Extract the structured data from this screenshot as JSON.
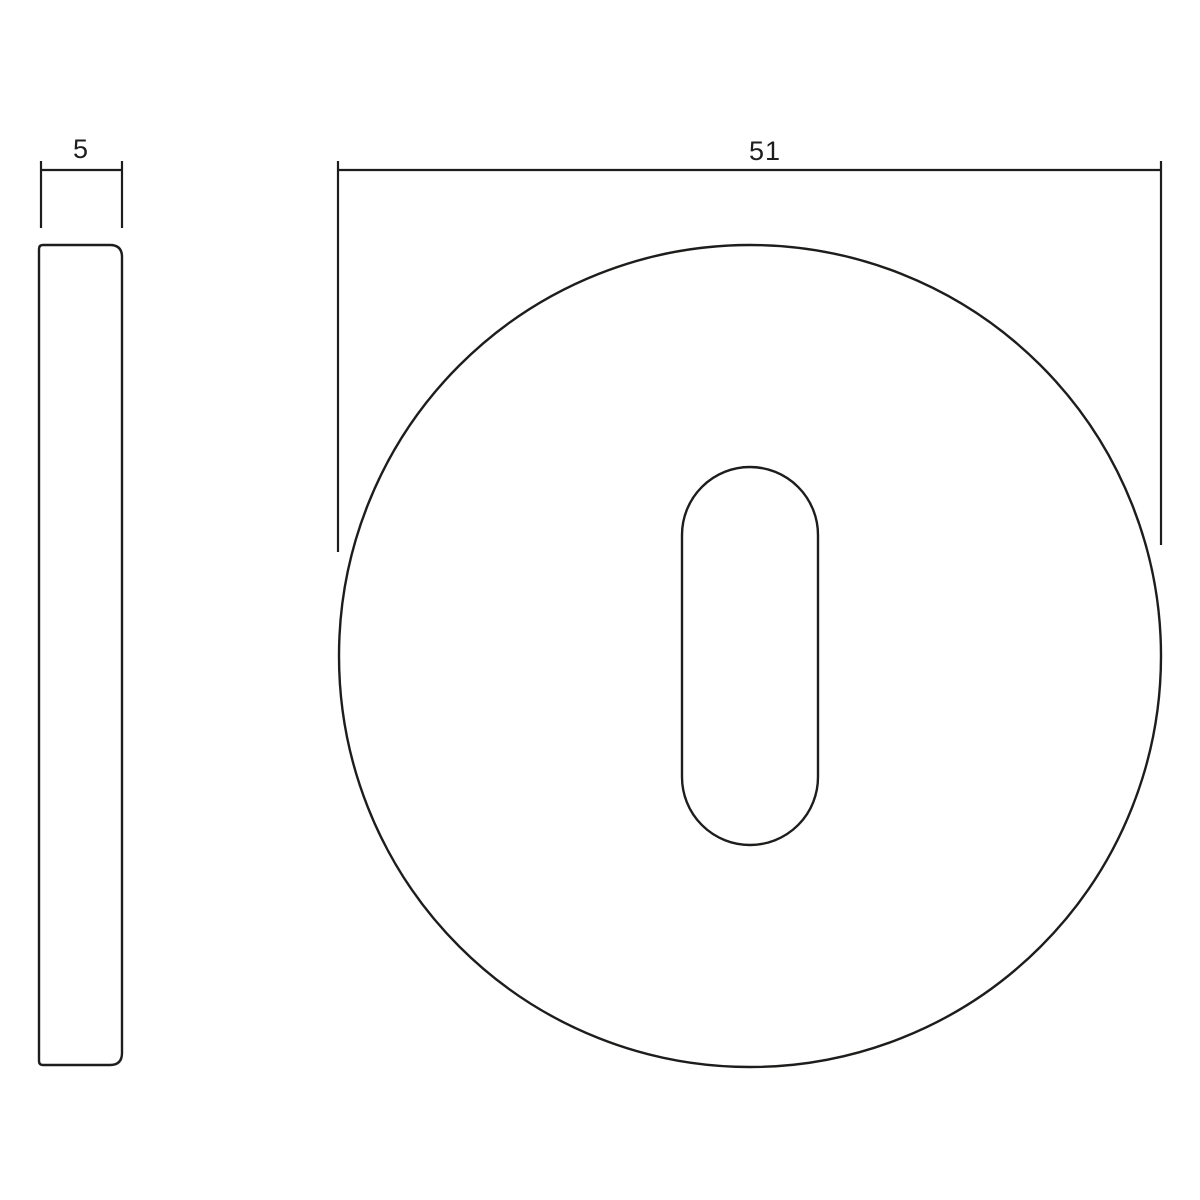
{
  "page": {
    "background_color": "#ffffff"
  },
  "drawing": {
    "line_color": "#1d1d1b",
    "side_view": {
      "dimension_label": "5"
    },
    "front_view": {
      "dimension_label": "51"
    }
  }
}
